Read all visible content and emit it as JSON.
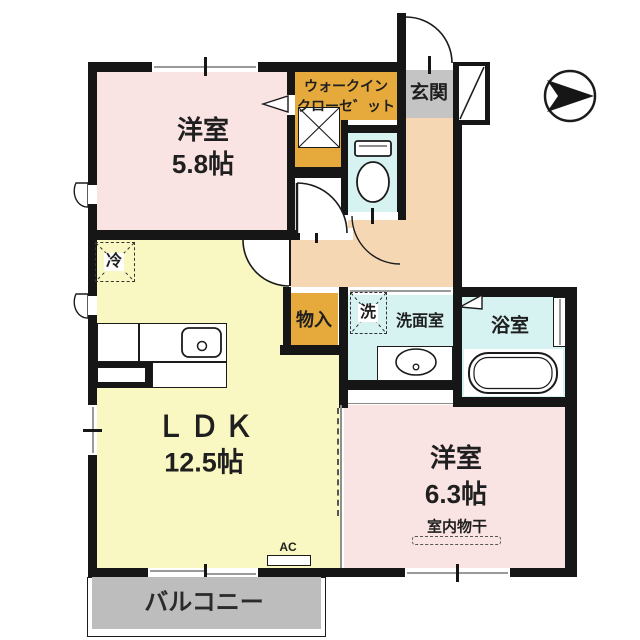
{
  "title": "apartment-floor-plan",
  "colors": {
    "wall": "#161616",
    "pink": "#fae3e3",
    "yellow": "#faf8c2",
    "orange": "#e6a93c",
    "genkan": "#c4c4c4",
    "hall": "#f6d7b4",
    "aqua": "#d6f3f2",
    "balcony": "#bdbdbd"
  },
  "rooms": {
    "room1": {
      "name": "洋室",
      "size": "5.8帖"
    },
    "ldk": {
      "name": "ＬＤＫ",
      "size": "12.5帖"
    },
    "room2": {
      "name": "洋室",
      "size": "6.3帖",
      "note": "室内物干"
    },
    "wic": {
      "line1": "ウォークイン",
      "line2": "クローセ゛ット"
    },
    "genkan": {
      "name": "玄関"
    },
    "washroom": {
      "name": "洗面室"
    },
    "bath": {
      "name": "浴室"
    },
    "storage": {
      "name": "物入"
    },
    "balcony": {
      "name": "バルコニー"
    }
  },
  "symbols": {
    "fridge": "冷",
    "washer": "洗",
    "ac": "AC"
  }
}
